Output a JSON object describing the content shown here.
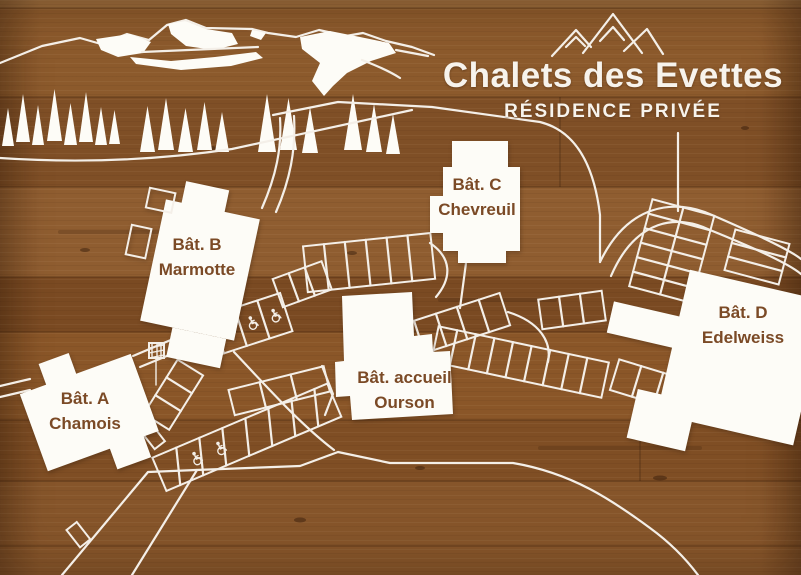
{
  "header": {
    "title": "Chalets des Evettes",
    "subtitle": "RÉSIDENCE PRIVÉE"
  },
  "buildings": [
    {
      "id": "batiment-a",
      "line1": "Bât. A",
      "line2": "Chamois"
    },
    {
      "id": "batiment-b",
      "line1": "Bât. B",
      "line2": "Marmotte"
    },
    {
      "id": "batiment-c",
      "line1": "Bât. C",
      "line2": "Chevreuil"
    },
    {
      "id": "batiment-accueil",
      "line1": "Bât. accueil",
      "line2": "Ourson"
    },
    {
      "id": "batiment-d",
      "line1": "Bât. D",
      "line2": "Edelweiss"
    }
  ],
  "icons": {
    "mountain_logo": "three-peaks-mountain",
    "accessible_parking": "wheelchair"
  },
  "colors": {
    "wood_base": "#8a5a2c",
    "linework": "#f4efe8",
    "building_fill": "#fdfcf7",
    "label_text": "#7b4a26",
    "title_text": "#f7f3ec"
  }
}
